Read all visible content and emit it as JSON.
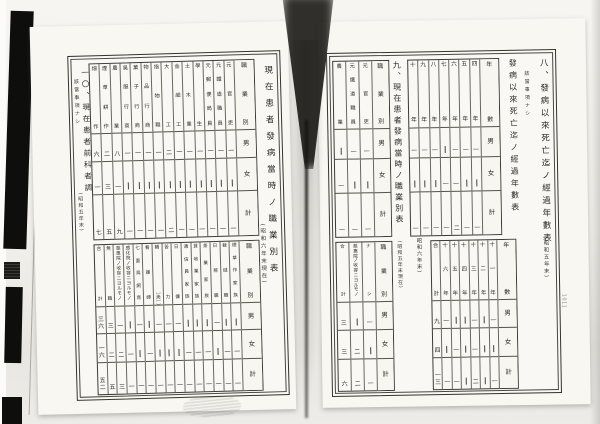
{
  "colors": {
    "paper": "#f9f8f4",
    "ink": "#2b2a25",
    "rule": "#55524a",
    "artifact_black": "#0e0e0d",
    "background": "#ecebe6"
  },
  "left_page": {
    "margin_mark": "1011",
    "table9_showa6": {
      "title": "現在患者發病當時ノ職業別表",
      "caption": "(昭和六年末現在)",
      "band1": {
        "header_label": "職業別",
        "row_labels": [
          "男",
          "女",
          "計"
        ],
        "columns": [
          {
            "label": "元官吏",
            "values": [
              "一",
              "—",
              "一"
            ]
          },
          {
            "label": "元鐵道職員",
            "values": [
              "一",
              "—",
              "一"
            ]
          },
          {
            "label": "元郵便局員",
            "values": [
              "一",
              "—",
              "一"
            ]
          },
          {
            "label": "學生",
            "values": [
              "一",
              "—",
              "一"
            ]
          },
          {
            "label": "土木業",
            "values": [
              "一",
              "—",
              "一"
            ]
          },
          {
            "label": "金細工",
            "values": [
              "一",
              "—",
              "一"
            ]
          },
          {
            "label": "大工",
            "values": [
              "二",
              "—",
              "二"
            ]
          },
          {
            "label": "指物職",
            "values": [
              "一",
              "—",
              "一"
            ]
          },
          {
            "label": "物品行商",
            "values": [
              "一",
              "—",
              "一"
            ]
          },
          {
            "label": "菓子行商",
            "values": [
              "一",
              "—",
              "一"
            ]
          },
          {
            "label": "吳服行商",
            "values": [
              "一",
              "—",
              "一"
            ]
          },
          {
            "label": "農業",
            "values": [
              "八",
              "一",
              "九"
            ]
          },
          {
            "label": "煙草耕作",
            "values": [
              "二",
              "三",
              "五"
            ]
          },
          {
            "label": "畑作",
            "values": [
              "六",
              "一",
              "七"
            ]
          }
        ]
      },
      "band2": {
        "header_label": "職業別",
        "row_labels": [
          "男",
          "女",
          "計"
        ],
        "columns": [
          {
            "label": "煙草作家族",
            "values": [
              "—",
              "一",
              "一"
            ]
          },
          {
            "label": "裁縫職",
            "values": [
              "—",
              "一",
              "一"
            ]
          },
          {
            "label": "日稼職",
            "values": [
              "一",
              "—",
              "一"
            ]
          },
          {
            "label": "茶業家族",
            "values": [
              "—",
              "一",
              "一"
            ]
          },
          {
            "label": "貸地業家族",
            "values": [
              "—",
              "一",
              "一"
            ]
          },
          {
            "label": "通信員家族",
            "values": [
              "—",
              "一",
              "一"
            ]
          },
          {
            "label": "日傭",
            "values": [
              "一",
              "—",
              "一"
            ]
          },
          {
            "label": "苦力",
            "values": [
              "一",
              "—",
              "一"
            ]
          },
          {
            "label": "轎夫",
            "values": [
              "一",
              "—",
              "一"
            ]
          },
          {
            "label": "看護婦",
            "values": [
              "—",
              "一",
              "一"
            ]
          },
          {
            "label": "七面鳥飼育",
            "values": [
              "一",
              "—",
              "一"
            ]
          },
          {
            "label": "感化院ノ收容ニヨルモノ",
            "values": [
              "—",
              "一",
              "一"
            ]
          },
          {
            "label": "慈惠院ノ收容ニヨルモノ",
            "values": [
              "一",
              "二",
              "三"
            ]
          },
          {
            "label": "無職",
            "values": [
              "三",
              "二",
              "五"
            ]
          },
          {
            "label": "合計",
            "values": [
              "三六",
              "一六",
              "五二"
            ]
          }
        ]
      }
    },
    "section10": {
      "title": "一〇、現在患者前科者調",
      "note": "該當事項ナシ",
      "caption": "(昭和五年末)"
    }
  },
  "right_page": {
    "margin_mark": "1011",
    "section8": {
      "title": "八、發病以來死亡迄ノ經過年數表",
      "caption": "(昭和五年末)",
      "note": "該當事項ナシ"
    },
    "table8_showa6": {
      "title": "發病以來死亡迄ノ經過年數表",
      "caption": "(昭和六年末)",
      "band1": {
        "header_label": "年數",
        "row_labels": [
          "男",
          "女",
          "計"
        ],
        "columns": [
          {
            "label": "四年",
            "values": [
              "一",
              "—",
              "一"
            ]
          },
          {
            "label": "五年",
            "values": [
              "一",
              "—",
              "一"
            ]
          },
          {
            "label": "六年",
            "values": [
              "一",
              "一",
              "二"
            ]
          },
          {
            "label": "七年",
            "values": [
              "—",
              "一",
              "一"
            ]
          },
          {
            "label": "八年",
            "values": [
              "一",
              "—",
              "一"
            ]
          },
          {
            "label": "九年",
            "values": [
              "一",
              "—",
              "一"
            ]
          },
          {
            "label": "十年",
            "values": [
              "一",
              "—",
              "一"
            ]
          }
        ]
      },
      "band2": {
        "header_label": "年數",
        "row_labels": [
          "男",
          "女",
          "計"
        ],
        "columns": [
          {
            "label": "十一年",
            "values": [
              "一",
              "—",
              "一"
            ]
          },
          {
            "label": "十二年",
            "values": [
              "—",
              "—",
              "—"
            ]
          },
          {
            "label": "十三年",
            "values": [
              "一",
              "一",
              "二"
            ]
          },
          {
            "label": "十四年",
            "values": [
              "—",
              "—",
              "—"
            ]
          },
          {
            "label": "十五年",
            "values": [
              "—",
              "一",
              "一"
            ]
          },
          {
            "label": "十六年",
            "values": [
              "一",
              "—",
              "一"
            ]
          },
          {
            "label": "合計",
            "values": [
              "九",
              "四",
              "一三"
            ]
          }
        ]
      }
    },
    "section9": {
      "title": "九、現在患者發病當時ノ職業別表",
      "caption": "(昭和五年末現在)"
    },
    "table9_showa5": {
      "band1": {
        "header_label": "職業別",
        "row_labels": [
          "男",
          "女",
          "計"
        ],
        "columns": [
          {
            "label": "元官吏",
            "values": [
              "一",
              "—",
              "一"
            ]
          },
          {
            "label": "元鐵道職員",
            "values": [
              "一",
              "—",
              "一"
            ]
          },
          {
            "label": "農業",
            "values": [
              "—",
              "一",
              "一"
            ]
          }
        ]
      },
      "band2": {
        "header_label": "職業別",
        "row_labels": [
          "男",
          "女",
          "計"
        ],
        "columns": [
          {
            "label": "ナシ",
            "values": [
              "一",
              "—",
              "一"
            ]
          },
          {
            "label": "慈惠院ノ收容ニヨルモノ",
            "values": [
              "—",
              "二",
              "二"
            ]
          },
          {
            "label": "合計",
            "values": [
              "三",
              "三",
              "六"
            ]
          }
        ]
      }
    }
  }
}
